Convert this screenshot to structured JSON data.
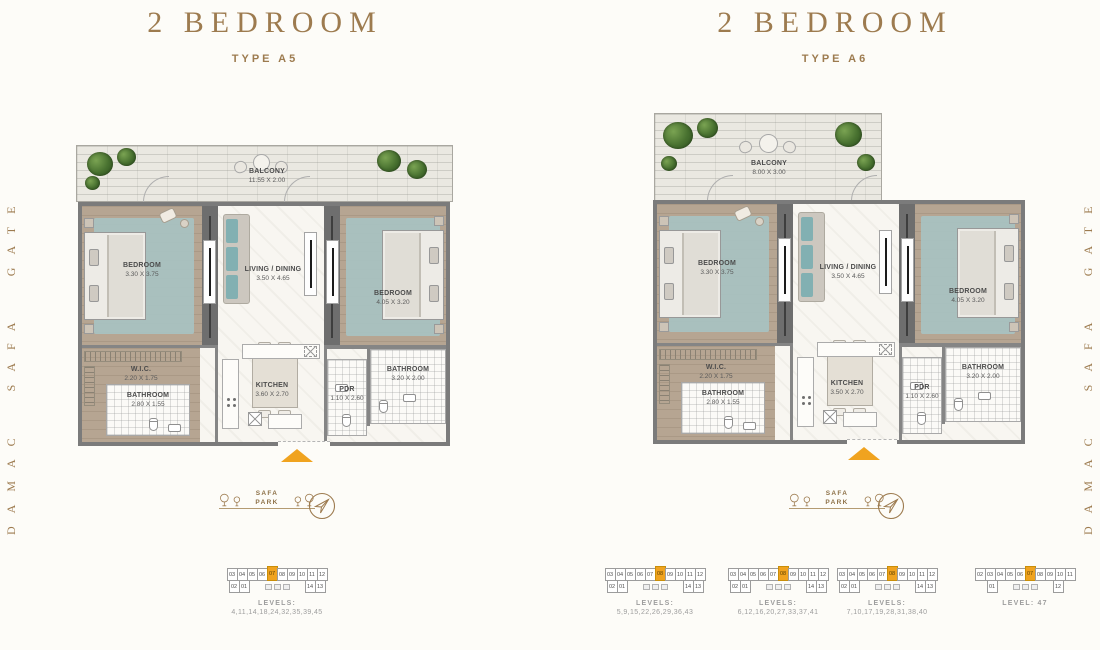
{
  "brand": {
    "side_text": "DAMAC SAFA GATE"
  },
  "colors": {
    "gold": "#9d7b4f",
    "highlight_orange": "#f0a31f",
    "background": "#fdfcf8"
  },
  "plans": [
    {
      "title": "2 BEDROOM",
      "subtitle": "TYPE A5",
      "park_label": "SAFA PARK",
      "rooms": {
        "balcony": {
          "label": "BALCONY",
          "dim": "11.55 X 2.00"
        },
        "bedroom1": {
          "label": "BEDROOM",
          "dim": "3.30 X 3.75"
        },
        "living": {
          "label": "LIVING / DINING",
          "dim": "3.50 X 4.65"
        },
        "bedroom2": {
          "label": "BEDROOM",
          "dim": "4.05 X 3.20"
        },
        "wic": {
          "label": "W.I.C.",
          "dim": "2.20 X 1.75"
        },
        "bathroom1": {
          "label": "BATHROOM",
          "dim": "2.80 X 1.55"
        },
        "kitchen": {
          "label": "KITCHEN",
          "dim": "3.60 X 2.70"
        },
        "pdr": {
          "label": "PDR",
          "dim": "1.10 X 2.60"
        },
        "bathroom2": {
          "label": "BATHROOM",
          "dim": "3.20 X 2.00"
        }
      },
      "diagrams": [
        {
          "caption1": "LEVELS:",
          "caption2": "4,11,14,18,24,32,35,39,45",
          "top_units": [
            "03",
            "04",
            "05",
            "06",
            "07",
            "08",
            "09",
            "10",
            "11",
            "12"
          ],
          "bottom_left_units": [
            "02",
            "01"
          ],
          "bottom_right_units": [
            "14",
            "13"
          ],
          "highlight_unit": "07"
        }
      ]
    },
    {
      "title": "2 BEDROOM",
      "subtitle": "TYPE A6",
      "park_label": "SAFA PARK",
      "rooms": {
        "balcony": {
          "label": "BALCONY",
          "dim": "8.00 X 3.00"
        },
        "bedroom1": {
          "label": "BEDROOM",
          "dim": "3.30 X 3.75"
        },
        "living": {
          "label": "LIVING / DINING",
          "dim": "3.50 X 4.65"
        },
        "bedroom2": {
          "label": "BEDROOM",
          "dim": "4.05 X 3.20"
        },
        "wic": {
          "label": "W.I.C.",
          "dim": "2.20 X 1.75"
        },
        "bathroom1": {
          "label": "BATHROOM",
          "dim": "2.80 X 1.55"
        },
        "kitchen": {
          "label": "KITCHEN",
          "dim": "3.50 X 2.70"
        },
        "pdr": {
          "label": "PDR",
          "dim": "1.10 X 2.60"
        },
        "bathroom2": {
          "label": "BATHROOM",
          "dim": "3.20 X 2.00"
        }
      },
      "diagrams": [
        {
          "caption1": "LEVELS:",
          "caption2": "5,9,15,22,26,29,36,43",
          "top_units": [
            "03",
            "04",
            "05",
            "06",
            "07",
            "08",
            "09",
            "10",
            "11",
            "12"
          ],
          "bottom_left_units": [
            "02",
            "01"
          ],
          "bottom_right_units": [
            "14",
            "13"
          ],
          "highlight_unit": "08"
        },
        {
          "caption1": "LEVELS:",
          "caption2": "6,12,16,20,27,33,37,41",
          "top_units": [
            "03",
            "04",
            "05",
            "06",
            "07",
            "08",
            "09",
            "10",
            "11",
            "12"
          ],
          "bottom_left_units": [
            "02",
            "01"
          ],
          "bottom_right_units": [
            "14",
            "13"
          ],
          "highlight_unit": "08"
        },
        {
          "caption1": "LEVELS:",
          "caption2": "7,10,17,19,28,31,38,40",
          "top_units": [
            "03",
            "04",
            "05",
            "06",
            "07",
            "08",
            "09",
            "10",
            "11",
            "12"
          ],
          "bottom_left_units": [
            "02",
            "01"
          ],
          "bottom_right_units": [
            "14",
            "13"
          ],
          "highlight_unit": "08"
        },
        {
          "caption1": "LEVEL: 47",
          "caption2": "",
          "top_units": [
            "02",
            "03",
            "04",
            "05",
            "06",
            "07",
            "08",
            "09",
            "10",
            "11"
          ],
          "bottom_left_units": [
            "01"
          ],
          "bottom_right_units": [
            "12"
          ],
          "highlight_unit": "07"
        }
      ]
    }
  ]
}
